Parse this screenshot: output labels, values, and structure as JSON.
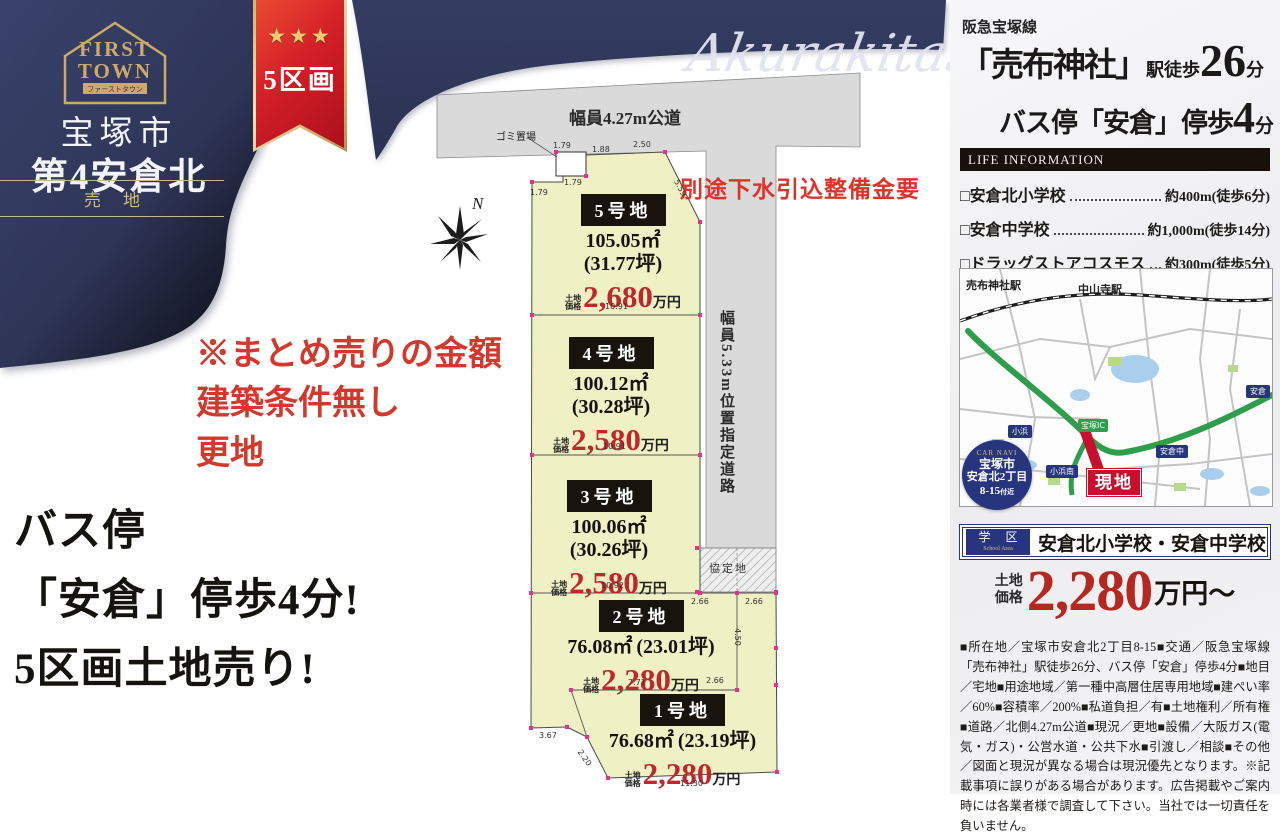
{
  "colors": {
    "navy": "#333b60",
    "ribbon_red": "#d31f27",
    "gold": "#c9a568",
    "plot_yellow": "#eff0c3",
    "road_gray": "#dadada",
    "price_red": "#c0272d",
    "pink_dot": "#e5328c",
    "map_navy": "#27357f"
  },
  "brand": {
    "logo_line1": "FIRST",
    "logo_line2": "TOWN",
    "logo_sub": "ファーストタウン",
    "city": "宝塚市",
    "name": "第4安倉北",
    "sale_badge": "売地",
    "ribbon_stars": "★★★",
    "ribbon_label": "5区画",
    "watermark": "Akurakita5"
  },
  "left_copy": {
    "red_note_line1": "※まとめ売りの金額",
    "red_note_line2": "建築条件無し",
    "red_note_line3": "更地",
    "headline_line1": "バス停",
    "headline_line2": "「安倉」停歩4分!",
    "headline_line3": "5区画土地売り!"
  },
  "siteplan": {
    "road_top_label": "幅員4.27m公道",
    "road_side_label": "幅員5.33m位置指定道路",
    "garbage_label": "ゴミ置場",
    "agreement_label": "協定地",
    "sewer_note": "別途下水引込整備金要",
    "compass_label": "N",
    "price_prefix_top": "土地",
    "price_prefix_bottom": "価格",
    "price_unit": "万円",
    "plots": [
      {
        "name": "5号地",
        "area": "105.05㎡",
        "tsubo": "(31.77坪)",
        "price": "2,680"
      },
      {
        "name": "4号地",
        "area": "100.12㎡",
        "tsubo": "(30.28坪)",
        "price": "2,580"
      },
      {
        "name": "3号地",
        "area": "100.06㎡",
        "tsubo": "(30.26坪)",
        "price": "2,580"
      },
      {
        "name": "2号地",
        "area": "76.08㎡",
        "tsubo": "(23.01坪)",
        "price": "2,280"
      },
      {
        "name": "1号地",
        "area": "76.68㎡",
        "tsubo": "(23.19坪)",
        "price": "2,280"
      }
    ],
    "dims": [
      {
        "v": "1.79",
        "x": 133,
        "y": 141,
        "r": 0
      },
      {
        "v": "1.88",
        "x": 172,
        "y": 145,
        "r": 0
      },
      {
        "v": "2.50",
        "x": 213,
        "y": 140,
        "r": 0
      },
      {
        "v": "5.59",
        "x": 260,
        "y": 178,
        "r": 62
      },
      {
        "v": "1.79",
        "x": 144,
        "y": 178,
        "r": 0
      },
      {
        "v": "1.79",
        "x": 110,
        "y": 188,
        "r": 0
      },
      {
        "v": "10.91",
        "x": 185,
        "y": 302,
        "r": 0
      },
      {
        "v": "10.91",
        "x": 183,
        "y": 442,
        "r": 0
      },
      {
        "v": "10.92",
        "x": 181,
        "y": 581,
        "r": 0
      },
      {
        "v": "2.66",
        "x": 271,
        "y": 597,
        "r": 0
      },
      {
        "v": "2.66",
        "x": 325,
        "y": 597,
        "r": 0
      },
      {
        "v": "7.71",
        "x": 208,
        "y": 678,
        "r": 0
      },
      {
        "v": "2.66",
        "x": 286,
        "y": 676,
        "r": 0
      },
      {
        "v": "4.50",
        "x": 322,
        "y": 628,
        "r": 90
      },
      {
        "v": "3.67",
        "x": 119,
        "y": 731,
        "r": 0
      },
      {
        "v": "2.20",
        "x": 163,
        "y": 748,
        "r": 55
      },
      {
        "v": "11.30",
        "x": 260,
        "y": 779,
        "r": 0
      }
    ]
  },
  "right_panel": {
    "rail_line": "阪急宝塚線",
    "station_quote": "「売布神社」",
    "station_mid": "駅徒歩",
    "station_num": "26",
    "station_unit": "分",
    "bus_pre": "バス停「安倉」停歩",
    "bus_num": "4",
    "bus_unit": "分",
    "life_title": "LIFE INFORMATION",
    "life_items": [
      {
        "name": "□安倉北小学校",
        "dist": "約400m(徒歩6分)"
      },
      {
        "name": "□安倉中学校",
        "dist": "約1,000m(徒歩14分)"
      },
      {
        "name": "□ドラッグストアコスモス",
        "dist": "約300m(徒歩5分)"
      }
    ],
    "map": {
      "labels": [
        {
          "t": "売布神社駅",
          "x": 6,
          "y": 8,
          "k": "station"
        },
        {
          "t": "中山寺駅",
          "x": 118,
          "y": 12,
          "k": "station"
        },
        {
          "t": "小浜",
          "x": 48,
          "y": 156,
          "k": "badge"
        },
        {
          "t": "小浜南",
          "x": 86,
          "y": 196,
          "k": "badge"
        },
        {
          "t": "安倉中",
          "x": 196,
          "y": 176,
          "k": "badge"
        },
        {
          "t": "安倉",
          "x": 286,
          "y": 116,
          "k": "badge"
        },
        {
          "t": "宝塚IC",
          "x": 118,
          "y": 150,
          "k": "ic"
        }
      ],
      "genchi": "現地",
      "car_navi": {
        "title": "CAR NAVI",
        "l1": "宝塚市",
        "l2": "安倉北2丁目",
        "l3": "8-15",
        "l3_small": "付近"
      }
    },
    "school": {
      "badge_top": "学 区",
      "badge_sub": "School Area",
      "text": "安倉北小学校・安倉中学校"
    },
    "price": {
      "prefix_top": "土地",
      "prefix_bottom": "価格",
      "num": "2,280",
      "suffix": "万円〜"
    },
    "legal": "■所在地／宝塚市安倉北2丁目8-15■交通／阪急宝塚線「売布神社」駅徒歩26分、バス停「安倉」停歩4分■地目／宅地■用途地域／第一種中高層住居専用地域■建ぺい率／60%■容積率／200%■私道負担／有■土地権利／所有権■道路／北側4.27m公道■現況／更地■設備／大阪ガス(電気・ガス)・公営水道・公共下水■引渡し／相談■その他／図面と現況が異なる場合は現況優先となります。※記載事項に誤りがある場合があります。広告掲載やご案内時には各業者様で調査して下さい。当社では一切責任を負いません。"
  }
}
